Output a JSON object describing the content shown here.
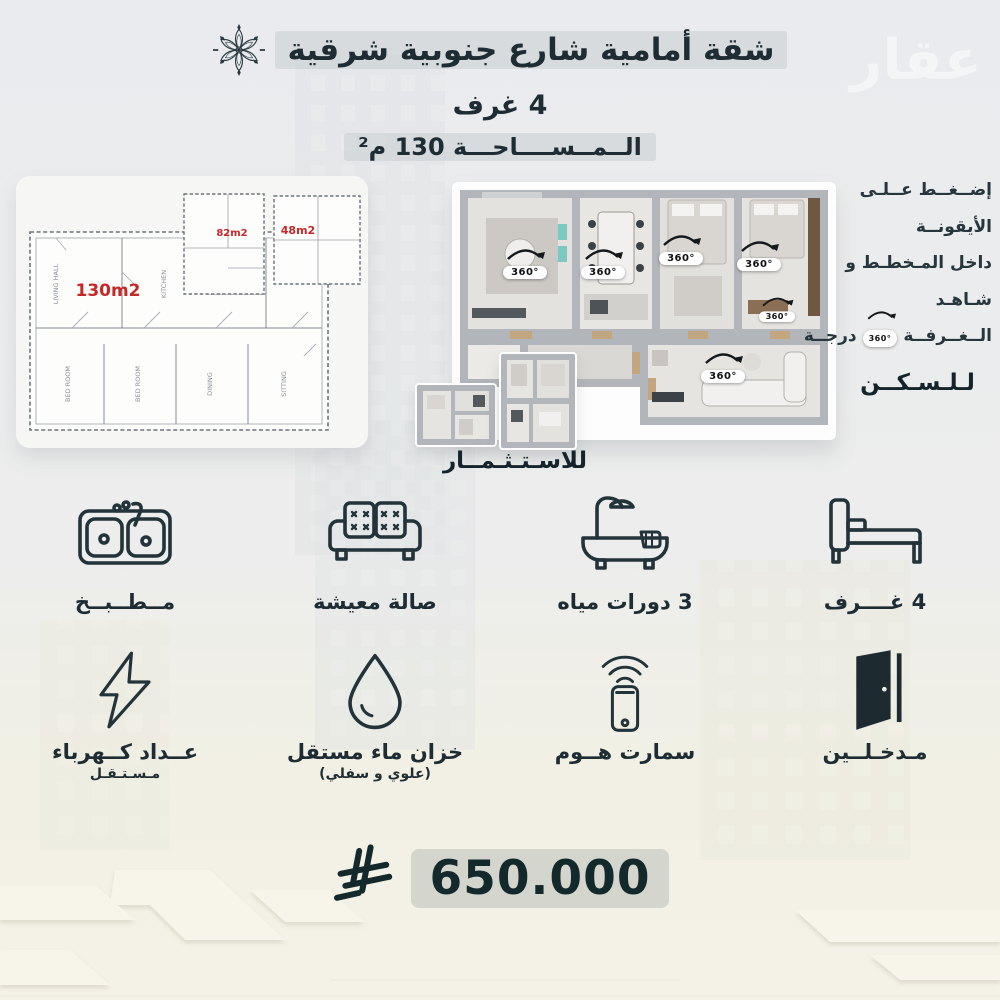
{
  "header": {
    "title": "شقة أمامية شارع جنوبية شرقية",
    "rooms_line": "4 غرف",
    "area_line": "الــمــســــاحـــة 130 م²"
  },
  "watermark": "عقار",
  "blueprint": {
    "area_main": "130m2",
    "area_mid": "82m2",
    "area_small": "48m2",
    "rooms": [
      "LIVING HALL",
      "KITCHEN",
      "BED ROOM",
      "BED ROOM",
      "DINING",
      "SITTING"
    ]
  },
  "plan3d": {
    "badge_label": "360°",
    "residence_label": "لـلـسـكــن",
    "investment_label": "للاسـتـثـمــار"
  },
  "instruction": {
    "line1": "إضــغــط عــلـى الأيقونــة",
    "line2": "داخل المـخطـط و شـاهـد",
    "line3_start": "الــغــرفــة",
    "line3_badge": "360°",
    "line3_end": "درجــة"
  },
  "features": [
    {
      "icon": "kitchen-sink-icon",
      "label": "مــطــبــخ",
      "sublabel": ""
    },
    {
      "icon": "sofa-icon",
      "label": "صالة معيشة",
      "sublabel": ""
    },
    {
      "icon": "bathtub-icon",
      "label": "3 دورات مياه",
      "sublabel": ""
    },
    {
      "icon": "bed-icon",
      "label": "4 غــــرف",
      "sublabel": ""
    },
    {
      "icon": "lightning-icon",
      "label": "عــداد كــهرباء",
      "sublabel": "مـسـتـقـل"
    },
    {
      "icon": "water-drop-icon",
      "label": "خزان ماء مستقل",
      "sublabel": "(علوي و سفلي)"
    },
    {
      "icon": "smart-home-icon",
      "label": "سمارت هــوم",
      "sublabel": ""
    },
    {
      "icon": "door-icon",
      "label": "مـدخـلــين",
      "sublabel": ""
    }
  ],
  "price": {
    "amount": "650.000",
    "currency_icon": "saudi-riyal-symbol"
  },
  "colors": {
    "text_dark": "#1e2c33",
    "red_label": "#c62828",
    "price_text": "#13292b",
    "badge_bg": "#ffffff",
    "background_top": "#e9ebee",
    "background_bottom": "#f4f2e6"
  }
}
